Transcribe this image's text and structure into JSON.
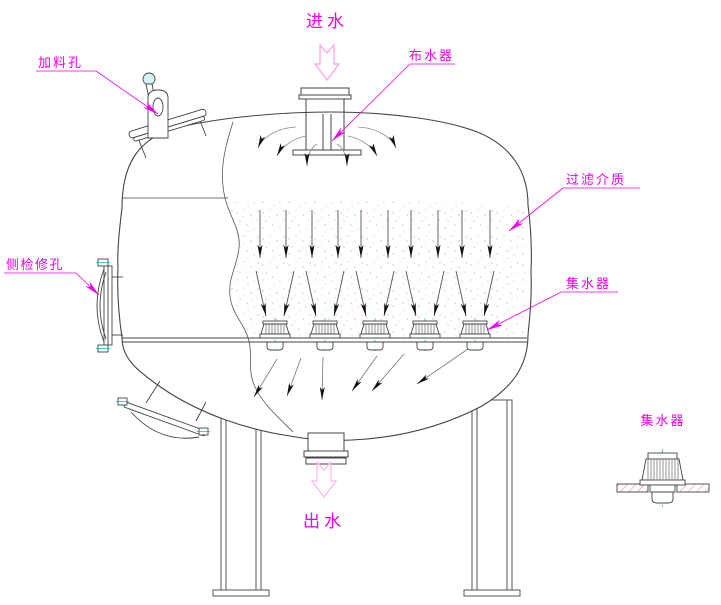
{
  "drawing": {
    "type": "mechanical-filter-vessel-section",
    "labels": {
      "inlet_flow": "进水",
      "outlet_flow": "出水",
      "feed_port": "加料孔",
      "distributor": "布水器",
      "filter_media": "过滤介质",
      "side_inspection_port": "侧检修孔",
      "collector": "集水器",
      "collector_detail": "集水器"
    },
    "colors": {
      "background": "#ffffff",
      "main_line": "#444444",
      "thin_line": "#8a8a8a",
      "arrow_head": "#111111",
      "annotation_magenta": "#ee00ee",
      "flow_arrow_pink": "#ff9ce8",
      "stipple_pink": "#ecb6cb",
      "centerline_teal": "#00b8a8",
      "hatch_red": "#f07878"
    }
  }
}
